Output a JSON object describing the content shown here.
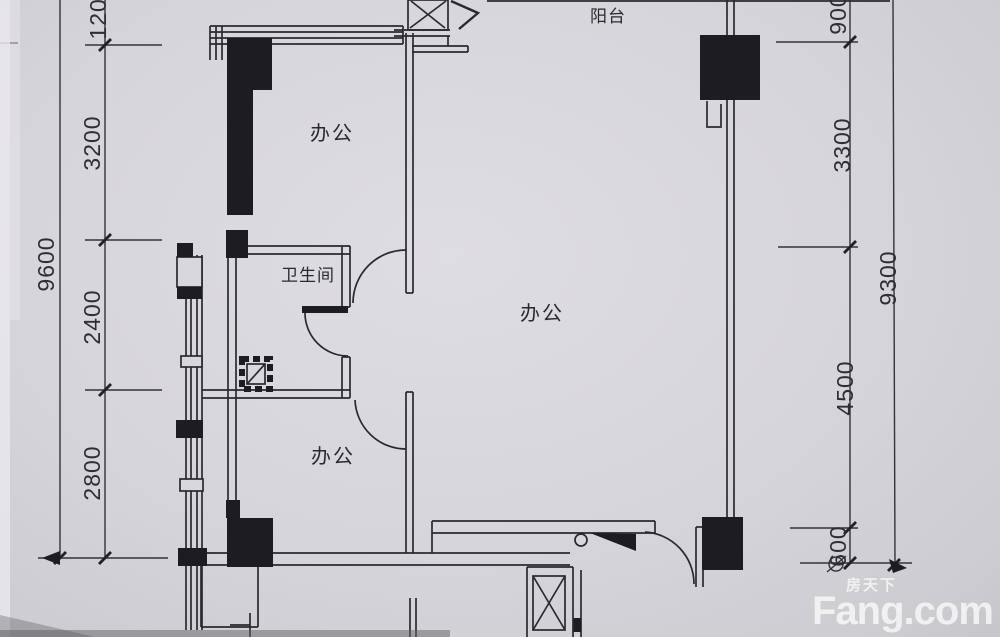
{
  "rooms": {
    "office_top_left": "办公",
    "office_main": "办公",
    "office_lower_left": "办公",
    "bathroom": "卫生间",
    "balcony": "阳台"
  },
  "dimensions": {
    "left": {
      "total": "9600",
      "segments": [
        "1200",
        "3200",
        "2400",
        "2800"
      ]
    },
    "right": {
      "total": "9300",
      "segments": [
        "900",
        "3300",
        "4500",
        "600"
      ]
    }
  },
  "watermark": {
    "brand": "Fang.com",
    "brand_cn": "房天下"
  },
  "colors": {
    "paper": "#d6d5d9",
    "line": "#2a2a2e",
    "wall_fill": "#1d1d21",
    "watermark": "#ffffff"
  }
}
